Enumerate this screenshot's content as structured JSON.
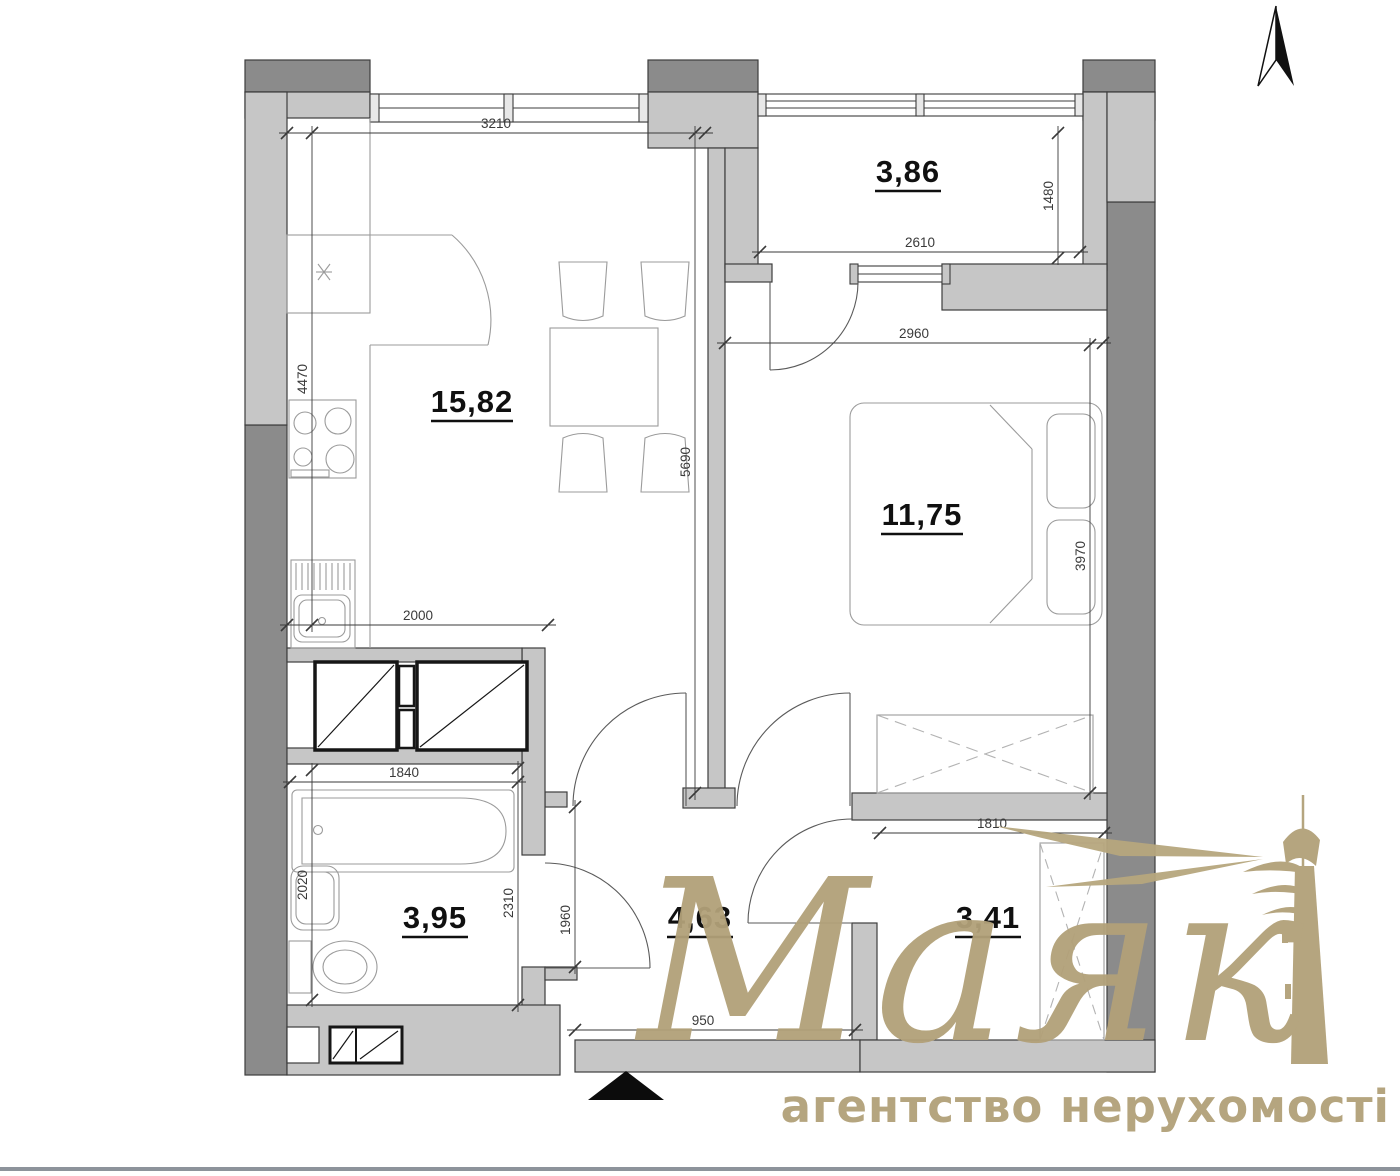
{
  "plan": {
    "rooms": [
      {
        "key": "living_kitchen",
        "area": "15,82"
      },
      {
        "key": "balcony",
        "area": "3,86"
      },
      {
        "key": "bedroom",
        "area": "11,75"
      },
      {
        "key": "bathroom",
        "area": "3,95"
      },
      {
        "key": "hallway",
        "area": "4,63"
      },
      {
        "key": "storage",
        "area": "3,41"
      }
    ],
    "dimensions": {
      "living_top": "3210",
      "living_left": "4470",
      "living_right": "5690",
      "kitchen_counter": "2000",
      "balcony_width": "2610",
      "balcony_depth": "1480",
      "bedroom_width": "2960",
      "bedroom_depth": "3970",
      "bath_width": "1840",
      "bath_left": "2020",
      "bath_right": "2310",
      "bath_door": "1960",
      "storage_width": "1810",
      "entry_width": "950"
    }
  },
  "logo": {
    "brand": "Маяк",
    "tagline": "агентство нерухомості"
  },
  "colors": {
    "wall_dark": "#8b8b8b",
    "wall_light": "#c6c6c6",
    "outline": "#3d3d3d",
    "fixture_line": "#9b9b9b",
    "dim_text": "#3a3a3a",
    "logo_gold": "#b2a179",
    "footer_line": "#8d939b"
  }
}
